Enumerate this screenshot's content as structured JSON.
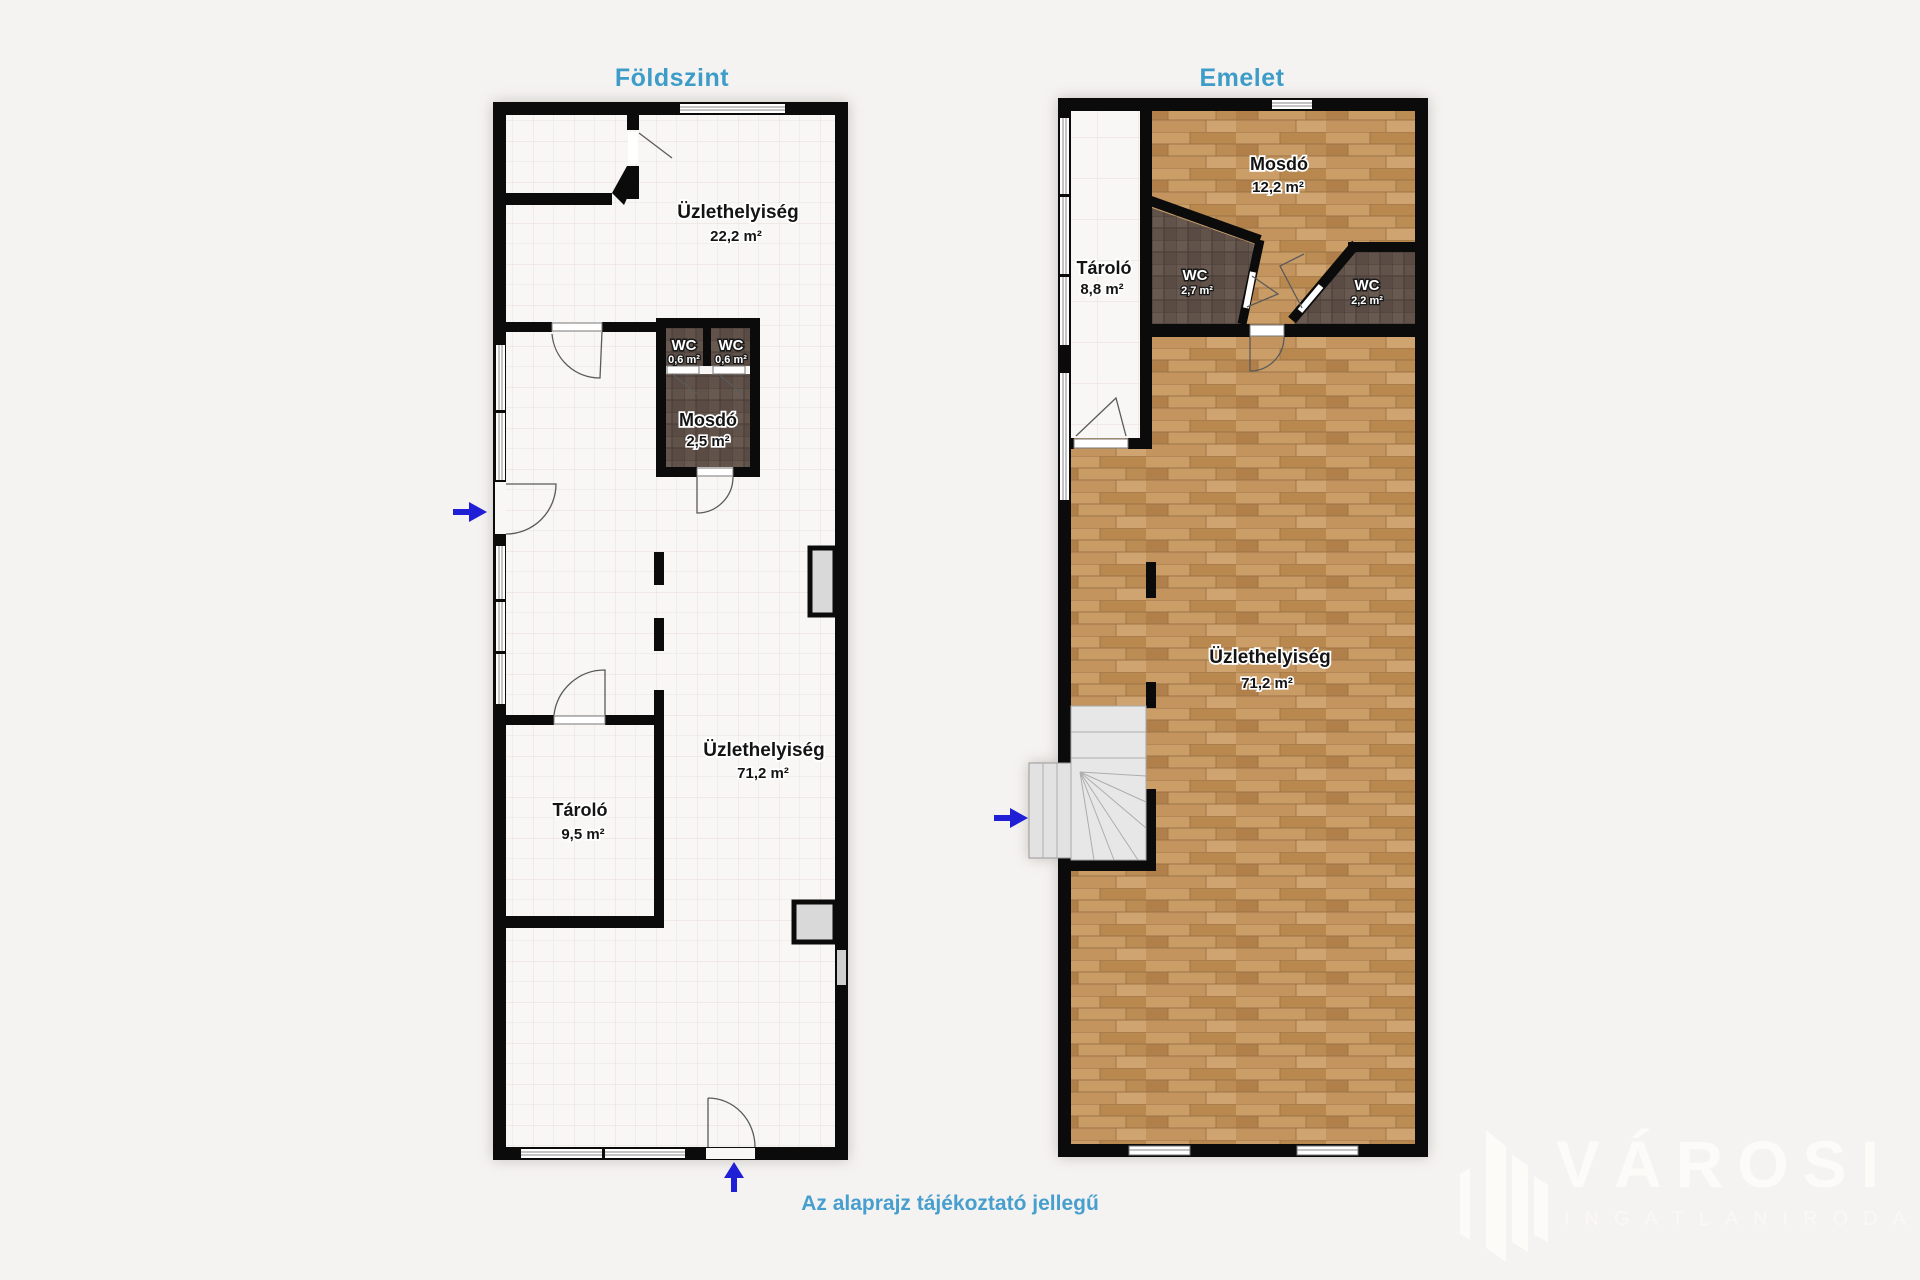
{
  "disclaimer": "Az alaprajz tájékoztató jellegű",
  "watermark": {
    "brand": "VÁROSI",
    "tagline": "INGATLANIRODA"
  },
  "colors": {
    "heading": "#3e9dc8",
    "disclaimer": "#469fce",
    "arrow": "#1f1fd6",
    "wall": "#0b0b0b",
    "wood_floor": "#c59a64",
    "tile_floor": "#61524a"
  },
  "floors": {
    "ground": {
      "title": "Földszint",
      "rooms": {
        "shop_top": {
          "name": "Üzlethelyiség",
          "area": "22,2 m²"
        },
        "wc_left": {
          "name": "WC",
          "area": "0,6 m²"
        },
        "wc_right": {
          "name": "WC",
          "area": "0,6 m²"
        },
        "washroom": {
          "name": "Mosdó",
          "area": "2,5 m²"
        },
        "shop_main": {
          "name": "Üzlethelyiség",
          "area": "71,2 m²"
        },
        "storage": {
          "name": "Tároló",
          "area": "9,5 m²"
        }
      }
    },
    "upper": {
      "title": "Emelet",
      "rooms": {
        "washroom": {
          "name": "Mosdó",
          "area": "12,2 m²"
        },
        "storage": {
          "name": "Tároló",
          "area": "8,8 m²"
        },
        "wc_left": {
          "name": "WC",
          "area": "2,7 m²"
        },
        "wc_right": {
          "name": "WC",
          "area": "2,2 m²"
        },
        "shop": {
          "name": "Üzlethelyiség",
          "area": "71,2 m²"
        }
      }
    }
  }
}
